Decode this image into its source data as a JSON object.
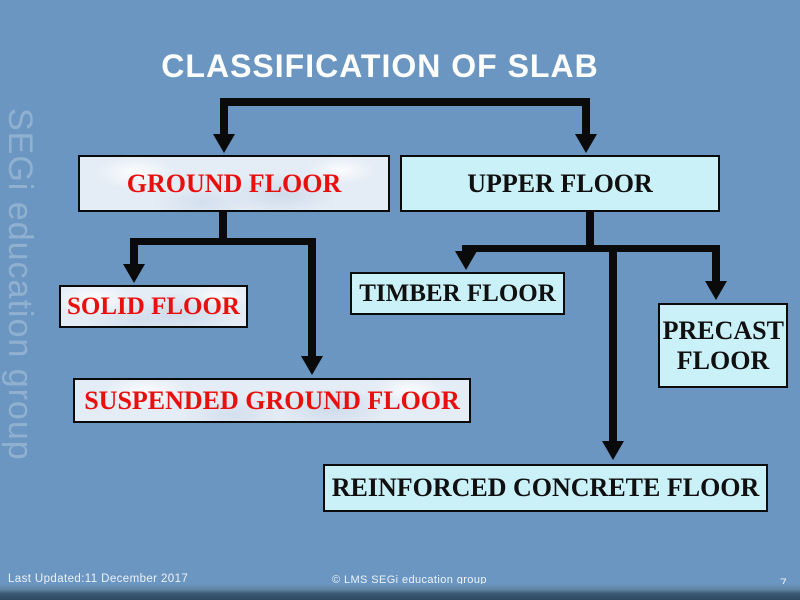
{
  "slide": {
    "title": "CLASSIFICATION OF SLAB",
    "watermark": "SEGi education group",
    "nodes": [
      {
        "id": "ground",
        "label": "GROUND FLOOR",
        "text_color": "#E8100E",
        "fill": "textured"
      },
      {
        "id": "upper",
        "label": "UPPER FLOOR",
        "text_color": "#101010",
        "fill": "cyan"
      },
      {
        "id": "solid",
        "label": "SOLID FLOOR",
        "text_color": "#E8100E",
        "fill": "textured"
      },
      {
        "id": "timber",
        "label": "TIMBER FLOOR",
        "text_color": "#101010",
        "fill": "cyan"
      },
      {
        "id": "precast",
        "label": "PRECAST FLOOR",
        "text_color": "#101010",
        "fill": "cyan"
      },
      {
        "id": "suspended",
        "label": "SUSPENDED GROUND FLOOR",
        "text_color": "#E8100E",
        "fill": "textured"
      },
      {
        "id": "reinforced",
        "label": "REINFORCED CONCRETE FLOOR",
        "text_color": "#101010",
        "fill": "cyan"
      }
    ],
    "hierarchy": [
      {
        "parent": "GROUND FLOOR",
        "children": [
          "SOLID FLOOR",
          "SUSPENDED GROUND FLOOR"
        ]
      },
      {
        "parent": "UPPER FLOOR",
        "children": [
          "TIMBER FLOOR",
          "REINFORCED CONCRETE FLOOR",
          "PRECAST FLOOR"
        ]
      }
    ],
    "footer": {
      "last_updated": "Last Updated:11 December 2017",
      "copyright": "© LMS SEGi education group",
      "page_number": "7"
    },
    "colors": {
      "background": "#6B96C1",
      "title_text": "#FFFFFF",
      "connector": "#0A0A0A",
      "box_border": "#0A0A0A",
      "cyan_fill": "#CBF1F8",
      "textured_fill": "#E4ECF5",
      "red_text": "#E8100E",
      "black_text": "#101010",
      "footer_bar": "#2C4860"
    },
    "icons": {
      "arrow_down": "css-triangle"
    }
  }
}
